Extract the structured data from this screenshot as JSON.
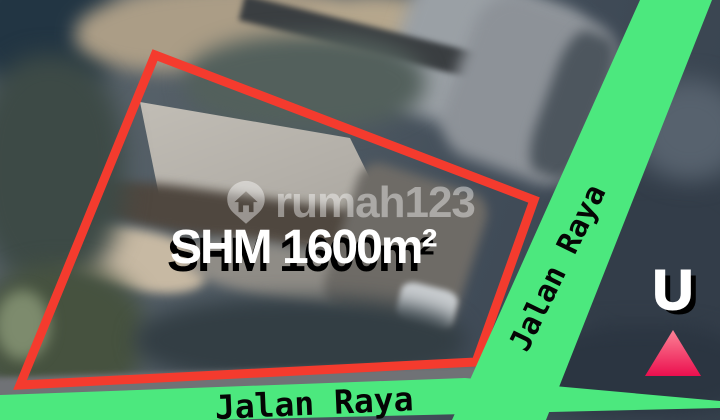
{
  "colors": {
    "boundary_red": "#f43b2e",
    "road_green": "#4ce87e",
    "road_label_black": "#050505",
    "area_label_white": "#ffffff",
    "area_label_shadow": "#000000",
    "north_letter_white": "#ffffff",
    "north_triangle_top": "#fc8396",
    "north_triangle_bottom": "#eb0f4e",
    "watermark_white_alpha": "rgba(255,255,255,0.42)"
  },
  "plot": {
    "area_label": "SHM 1600m²",
    "boundary_points": "155,55 534,200 476,362 20,385"
  },
  "roads": {
    "diagonal": {
      "label": "Jalan Raya",
      "points": "640,0 712,0 546,420 452,420"
    },
    "bottom": {
      "label": "Jalan Raya",
      "points": "0,395 465,378 720,401 720,408 0,425"
    }
  },
  "watermark": {
    "brand": "rumah123",
    "logo_icon": "house-pin-icon"
  },
  "compass": {
    "letter": "U",
    "arrow_icon": "north-arrow-icon"
  }
}
